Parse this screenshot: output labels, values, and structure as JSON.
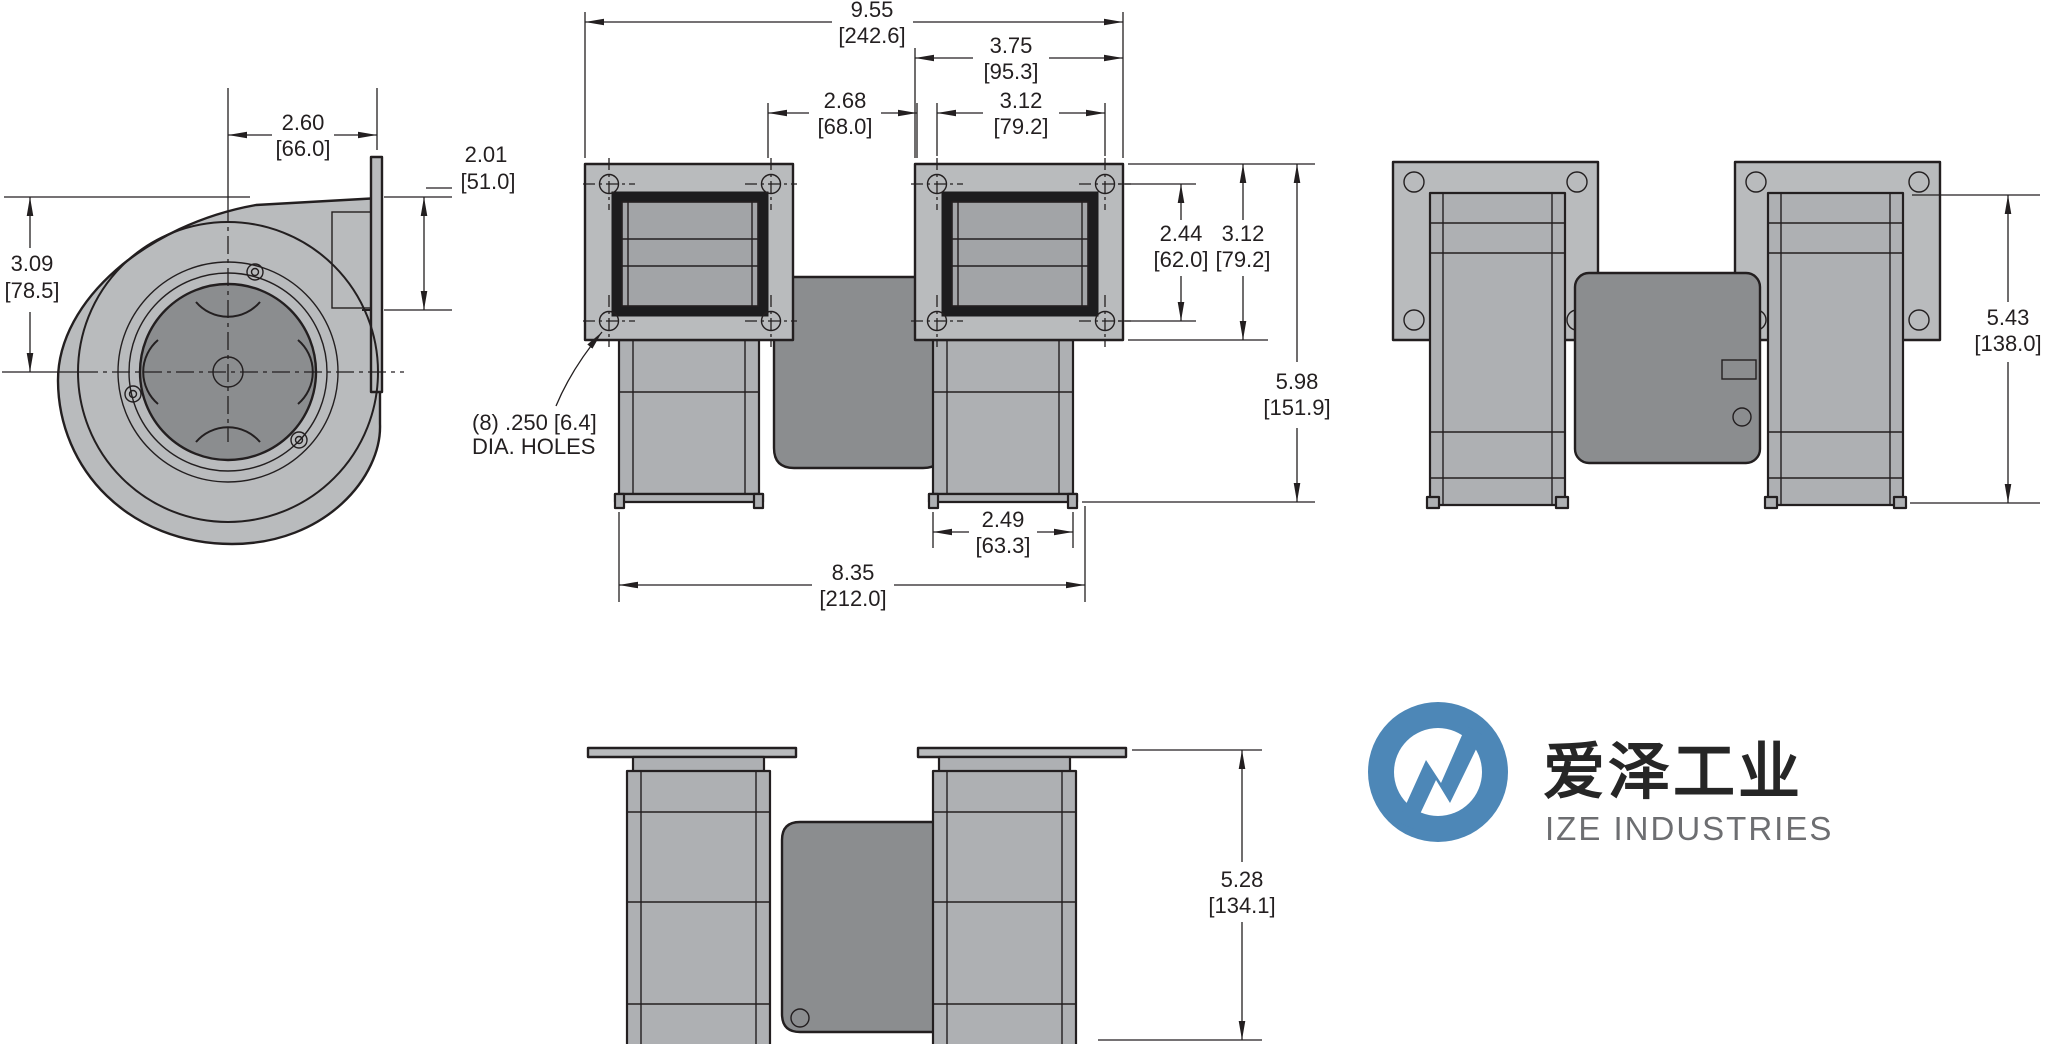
{
  "drawing": {
    "dims": {
      "scroll_depth": {
        "in": "2.60",
        "mm": "[66.0]"
      },
      "outlet_height": {
        "in": "2.01",
        "mm": "[51.0]"
      },
      "center_height": {
        "in": "3.09",
        "mm": "[78.5]"
      },
      "overall_width": {
        "in": "9.55",
        "mm": "[242.6]"
      },
      "flange_width": {
        "in": "3.75",
        "mm": "[95.3]"
      },
      "flange_gap": {
        "in": "2.68",
        "mm": "[68.0]"
      },
      "hole_pitch_h": {
        "in": "3.12",
        "mm": "[79.2]"
      },
      "hole_pitch_v": {
        "in": "2.44",
        "mm": "[62.0]"
      },
      "flange_height": {
        "in": "3.12",
        "mm": "[79.2]"
      },
      "overall_height": {
        "in": "5.98",
        "mm": "[151.9]"
      },
      "body_width": {
        "in": "2.49",
        "mm": "[63.3]"
      },
      "feet_span": {
        "in": "8.35",
        "mm": "[212.0]"
      },
      "side_height": {
        "in": "5.43",
        "mm": "[138.0]"
      },
      "overall_depth": {
        "in": "5.28",
        "mm": "[134.1]"
      }
    },
    "note": {
      "line1": "(8) .250 [6.4]",
      "line2": "DIA. HOLES"
    },
    "logo": {
      "zh": "爱泽工业",
      "en": "IZE INDUSTRIES"
    },
    "colors": {
      "line": "#231f20",
      "metal_light": "#b9bbbd",
      "metal_mid": "#aeb0b3",
      "metal_dark": "#8b8d8f",
      "logo_blue": "#4d87b7",
      "logo_text_gray": "#6d6e71"
    }
  }
}
